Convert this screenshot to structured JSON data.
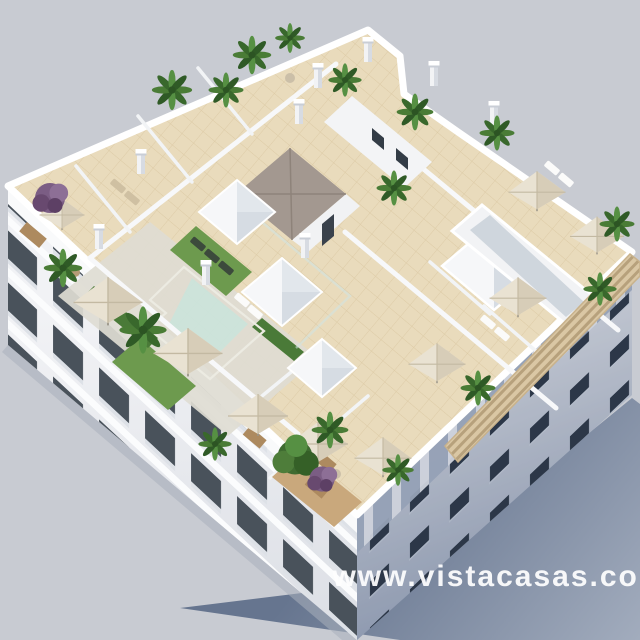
{
  "watermark": {
    "text": "www.vistacasas.com",
    "color": "#ffffff"
  },
  "scene": {
    "kind": "3d-architectural-render",
    "subject": "aerial isometric view of an apartment building rooftop solarium",
    "features": [
      "communal L-shaped pool",
      "private rooftop terraces",
      "beige parasols",
      "sun loungers",
      "palm plants and purple shrubs",
      "pyramid skylights",
      "wood slat pergola",
      "white chimneys",
      "tiled stairwell roof"
    ]
  },
  "colors": {
    "background": "#c8cbd2",
    "ground_shadow": "#76859e",
    "roof_tile": "#e9dbbc",
    "building_white": "#f4f5f7",
    "pool_water": "#6fc9c4",
    "pool_highlight": "#b5ece4",
    "grass_green": "#6d9a4e",
    "hedge_green": "#4a7a38",
    "wood_deck": "#c9a87c",
    "pergola_wood": "#dac7a4",
    "stair_roof_gray": "#a39890",
    "facade_lit": "#eceef1",
    "facade_shaded": "#a9b4c6",
    "window_dark": "#39424b",
    "parasol_beige": "#e9e2d2",
    "plant_green": "#4a7c36",
    "plant_purple": "#7b5d84"
  }
}
